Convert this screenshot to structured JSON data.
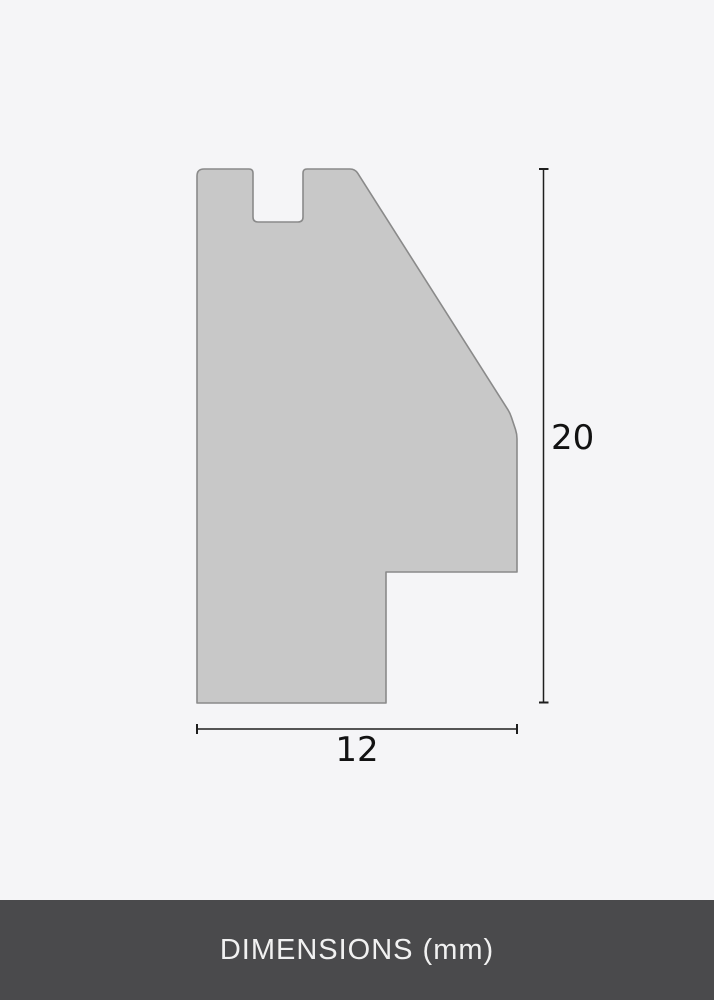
{
  "diagram": {
    "height_value": "20",
    "width_value": "12",
    "unit": "mm",
    "shape_fill": "#c8c8c8",
    "shape_outline": "#8a8a8a",
    "dimension_line_color": "#1e1e1e",
    "label_color": "#121212",
    "background": "#f5f5f7"
  },
  "footer": {
    "label": "DIMENSIONS (mm)",
    "background": "#4a4a4c",
    "text_color": "#f1f1f1"
  }
}
